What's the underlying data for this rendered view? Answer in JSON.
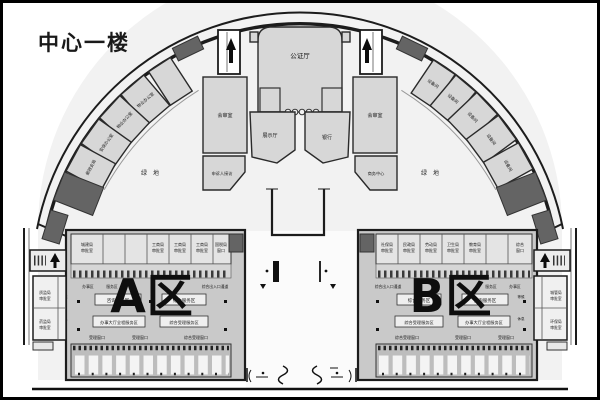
{
  "title": "中心一楼",
  "hall": {
    "label": "公证厅"
  },
  "mid": {
    "review_left": "会审室",
    "review_right": "会审室",
    "exhibit": "展示厅",
    "bank": "银行",
    "petition": "申诉人接访",
    "business": "商务中心"
  },
  "green": {
    "left": "绿地",
    "right": "绿地"
  },
  "arc_left": {
    "rooms": [
      "物业办公室",
      "物业办公室",
      "安保办公室",
      "邮政支局"
    ]
  },
  "arc_right": {
    "rooms": [
      "设备间",
      "设备间",
      "设备间",
      "设备间",
      "设备间"
    ]
  },
  "block_a": {
    "zone": "A区",
    "cells": [
      {
        "l1": "城建局",
        "l2": "审批室"
      },
      {
        "l1": "工商局",
        "l2": "审批室"
      },
      {
        "l1": "工商局",
        "l2": "审批室"
      },
      {
        "l1": "工商局",
        "l2": "审批室"
      },
      {
        "l1": "国税局",
        "l2": "窗口"
      }
    ],
    "micro": [
      "办事区",
      "服务区",
      "综合出入口通道"
    ],
    "boxes": [
      "咨询服务区",
      "综合服务区",
      "办事大厅全程服务区",
      "综合受理服务区"
    ],
    "row2": [
      "受理窗口",
      "受理窗口",
      "综合受理窗口"
    ],
    "side": [
      "等候",
      "休息"
    ]
  },
  "block_b": {
    "zone": "B区",
    "cells": [
      {
        "l1": "社保局",
        "l2": "审批室"
      },
      {
        "l1": "民政局",
        "l2": "审批室"
      },
      {
        "l1": "劳动局",
        "l2": "审批室"
      },
      {
        "l1": "卫生局",
        "l2": "审批室"
      },
      {
        "l1": "教育局",
        "l2": "审批室"
      },
      {
        "l1": "综合",
        "l2": "窗口"
      }
    ],
    "micro": [
      "综合出入口通道",
      "服务区",
      "办事区"
    ],
    "boxes": [
      "综合服务区",
      "咨询服务区",
      "综合受理服务区",
      "办事大厅全程服务区"
    ],
    "row2": [
      "综合受理窗口",
      "受理窗口",
      "受理窗口"
    ],
    "side": [
      "等候",
      "休息"
    ]
  },
  "edge_left": {
    "cells": [
      {
        "l1": "质监局",
        "l2": "审批室"
      },
      {
        "l1": "药监局",
        "l2": "审批室"
      }
    ]
  },
  "edge_right": {
    "cells": [
      {
        "l1": "城管局",
        "l2": "审批室"
      },
      {
        "l1": "环保局",
        "l2": "审批室"
      }
    ]
  }
}
